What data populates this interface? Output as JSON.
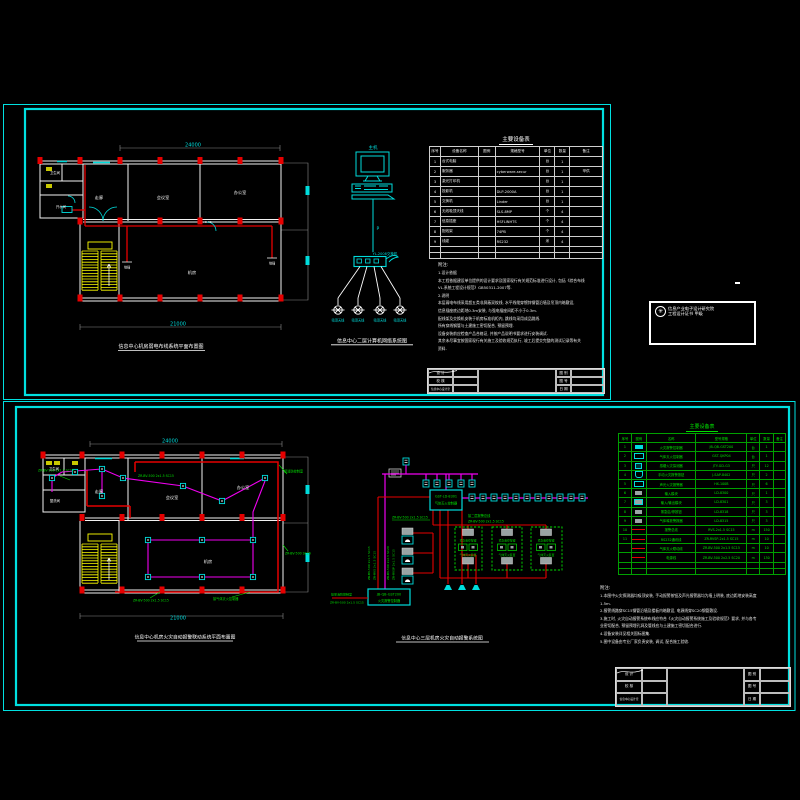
{
  "colors": {
    "frame": "#00e0e0",
    "red": "#e60000",
    "magenta": "#f000f0",
    "yellow": "#ffff00",
    "green": "#00e000",
    "white": "#ffffff"
  },
  "sheet1": {
    "plan": {
      "title": "信息中心机房弱电布线系统平面布置图",
      "dim_top": "24000",
      "dim_bottom": "21000",
      "rooms": {
        "corridor": "走廊",
        "meeting": "会议室",
        "office": "办公室",
        "machine": "机房",
        "pantry": "开水间",
        "wash": "卫生间"
      },
      "labels": {
        "outlet": "地插",
        "level": "+0.30"
      }
    },
    "network": {
      "host": "主机",
      "cable": "P",
      "switch_name": "YL-2008交换机",
      "ap": "吸顶天线",
      "title": "信息中心二层计算机网络系统图"
    },
    "equip_table": {
      "title": "主要设备表",
      "headers": [
        "序号",
        "设备名称",
        "图例",
        "规格型号",
        "单位",
        "数量",
        "备注"
      ],
      "rows": [
        {
          "no": "1",
          "name": "台式电脑",
          "spec": "",
          "unit": "台",
          "qty": "1",
          "note": ""
        },
        {
          "no": "2",
          "name": "服务器",
          "spec": "cyberware-secur",
          "unit": "台",
          "qty": "1",
          "note": "甲供"
        },
        {
          "no": "3",
          "name": "激光打印机",
          "spec": "",
          "unit": "台",
          "qty": "1",
          "note": ""
        },
        {
          "no": "4",
          "name": "投影机",
          "spec": "DLP-2000A",
          "unit": "台",
          "qty": "1",
          "note": ""
        },
        {
          "no": "5",
          "name": "交换机",
          "spec": "Linder",
          "unit": "台",
          "qty": "1",
          "note": ""
        },
        {
          "no": "6",
          "name": "无线吸顶天线",
          "spec": "SLS-8MP",
          "unit": "个",
          "qty": "4",
          "note": ""
        },
        {
          "no": "7",
          "name": "信息插座",
          "spec": "HSFLINHTS",
          "unit": "个",
          "qty": "4",
          "note": ""
        },
        {
          "no": "8",
          "name": "配线架",
          "spec": "74PB",
          "unit": "个",
          "qty": "4",
          "note": ""
        },
        {
          "no": "9",
          "name": "线缆",
          "spec": "RS232",
          "unit": "米",
          "qty": "4",
          "note": ""
        }
      ]
    },
    "notes": {
      "label": "附注:",
      "lines": [
        "1.设计依据",
        "   本工程依据建设单位提供的设计要求及国家现行有关规范标准进行设计, 包括《综合布线",
        "VL.系统工程设计规范》GB50311-2007等.",
        "2.说明",
        "   本层弱电布线采用超五类非屏蔽双绞线, 水平线缆穿镀锌钢管沿墙及吊顶内暗敷设,",
        "信息插座底边距地0.3m安装, 与强电插座间距不小于0.3m.",
        "   配线架及交换机安装于机房标准机柜内, 跳线均采用成品跳线.",
        "   所有穿线钢管与土建施工密切配合, 预留预埋.",
        "   设备安装前应检查产品合格证, 并按产品说明书要求进行安装调试.",
        "   其余未尽事宜按国家现行有关施工及验收规范执行, 竣工后提交完整的测试记录等有关",
        "资料."
      ]
    },
    "titleblock": {
      "design": "设 计",
      "check": "校 核",
      "dept": "信息中心设计室",
      "f1": "图 别",
      "f2": "图 号",
      "f3": "日 期"
    },
    "stamp": {
      "line1": "信息产业电子设计研究院",
      "line2": "工程设计证书 甲级"
    }
  },
  "sheet2": {
    "plan": {
      "title": "信息中心机房火灾自动报警联动系统平面布置图",
      "dim_top": "24000",
      "dim_bottom": "21000",
      "rooms": {
        "corridor": "走廊",
        "meeting": "会议室",
        "office": "办公室",
        "machine": "机房",
        "wash": "盥洗间",
        "wc": "卫生间"
      },
      "tags": [
        "ZR-BV-500 2x1.5 SC15",
        "ZR-BV-500 2x1.5 SC15",
        "ZR-BV-500 2x1.5 SC15",
        "接气体灭火控制器",
        "接消防控制室",
        "ZR-BV-500 SC15"
      ]
    },
    "system": {
      "title": "信息中心三层机房火灾自动报警系统图",
      "controller": [
        "JB-QB-GST200",
        "火灾报警控制器"
      ],
      "panel": [
        "GST-LD-8301",
        "气体灭火控制器"
      ],
      "tag_left": "ZR-BV-500 2x1.5 SC15",
      "bus_label1": "接二层报警总线",
      "bus_label2": "ZR-BV-500 2x1.5 SC15",
      "feed1": "接至消防控制室",
      "feed2": "ZR-BV-500 2x1.5 SC15",
      "vtags": [
        "ZR-BV-500 2x1.5 SC15",
        "ZR-RVS 2x1.5 SC15",
        "ZR-BV-500 2x2.5 SC20",
        "ZR-RVSP 2x1.5 SC15"
      ],
      "zone_btn": "紧急启停按钮",
      "zone_dev": "气体灭火装置"
    },
    "equip_table": {
      "title": "主要设备表",
      "headers": [
        "序号",
        "图例",
        "名称",
        "型号规格",
        "单位",
        "数量",
        "备注"
      ],
      "rows": [
        {
          "no": "1",
          "sym": "sym sym-fill",
          "name": "火灾报警控制器",
          "spec": "JB-QB-GST200",
          "unit": "台",
          "qty": "1",
          "note": ""
        },
        {
          "no": "2",
          "sym": "sym sym-open",
          "name": "气体灭火控制器",
          "spec": "GST-QKP04",
          "unit": "台",
          "qty": "1",
          "note": ""
        },
        {
          "no": "3",
          "sym": "sym sym-dot",
          "name": "感烟火灾探测器",
          "spec": "JTY-GD-G3",
          "unit": "只",
          "qty": "12",
          "note": ""
        },
        {
          "no": "4",
          "sym": "sym sym-bell",
          "name": "手动火灾报警按钮",
          "spec": "J-SAP-8402",
          "unit": "只",
          "qty": "2",
          "note": ""
        },
        {
          "no": "5",
          "sym": "sym sym-open",
          "name": "声光火灾报警器",
          "spec": "HX-100B",
          "unit": "只",
          "qty": "6",
          "note": ""
        },
        {
          "no": "6",
          "sym": "sym sym-gray",
          "name": "输入模块",
          "spec": "LD-8300",
          "unit": "只",
          "qty": "1",
          "note": ""
        },
        {
          "no": "7",
          "sym": "sym sym-grayc",
          "name": "输入/输出模块",
          "spec": "LD-8301",
          "unit": "只",
          "qty": "3",
          "note": ""
        },
        {
          "no": "8",
          "sym": "sym sym-gray",
          "name": "紧急启/停按钮",
          "spec": "LD-8318",
          "unit": "只",
          "qty": "3",
          "note": ""
        },
        {
          "no": "9",
          "sym": "sym sym-gray",
          "name": "气体释放警报器",
          "spec": "LD-8315",
          "unit": "只",
          "qty": "3",
          "note": ""
        },
        {
          "no": "10",
          "sym": "sym sym-line",
          "name": "报警总线",
          "spec": "RVS-2x1.5 SC15",
          "unit": "m",
          "qty": "150",
          "note": ""
        },
        {
          "no": "11",
          "sym": "sym sym-line",
          "name": "RS232通讯线",
          "spec": "ZR-RVSP-2x1.5 SC15",
          "unit": "m",
          "qty": "10",
          "note": ""
        },
        {
          "no": "",
          "sym": "sym sym-line",
          "name": "气体灭火联动线",
          "spec": "ZR-BV-500 2x1.5 SC15",
          "unit": "m",
          "qty": "10",
          "note": ""
        },
        {
          "no": "",
          "sym": "sym sym-line",
          "name": "电源线",
          "spec": "ZR-BV-500 2x2.5 SC20",
          "unit": "m",
          "qty": "130",
          "note": ""
        }
      ]
    },
    "notes": {
      "label": "附注:",
      "lines": [
        "1.本图中火灾探测器均吸顶安装, 手动报警按钮及声光报警器均为墙上明装, 底边距地安装高度",
        "   1.5m.",
        "2.报警线路穿SC15钢管沿墙及楼板内暗敷设, 电源线穿SC20钢管敷设.",
        "3.施工时, 火灾自动报警系统布线应符合《火灾自动报警系统施工及验收规范》要求, 并与各专",
        "   业密切配合, 预留预埋孔洞及管线应与土建施工密切配合进行.",
        "4.设备安装详见相关国标图集.",
        "5.图中设备由专业厂家负责安装, 调试, 配合施工验收."
      ]
    },
    "titleblock": {
      "design": "设 计",
      "check": "校 核",
      "dept": "信息中心设计室",
      "f1": "图 别",
      "f2": "图 号",
      "f3": "日 期"
    }
  }
}
